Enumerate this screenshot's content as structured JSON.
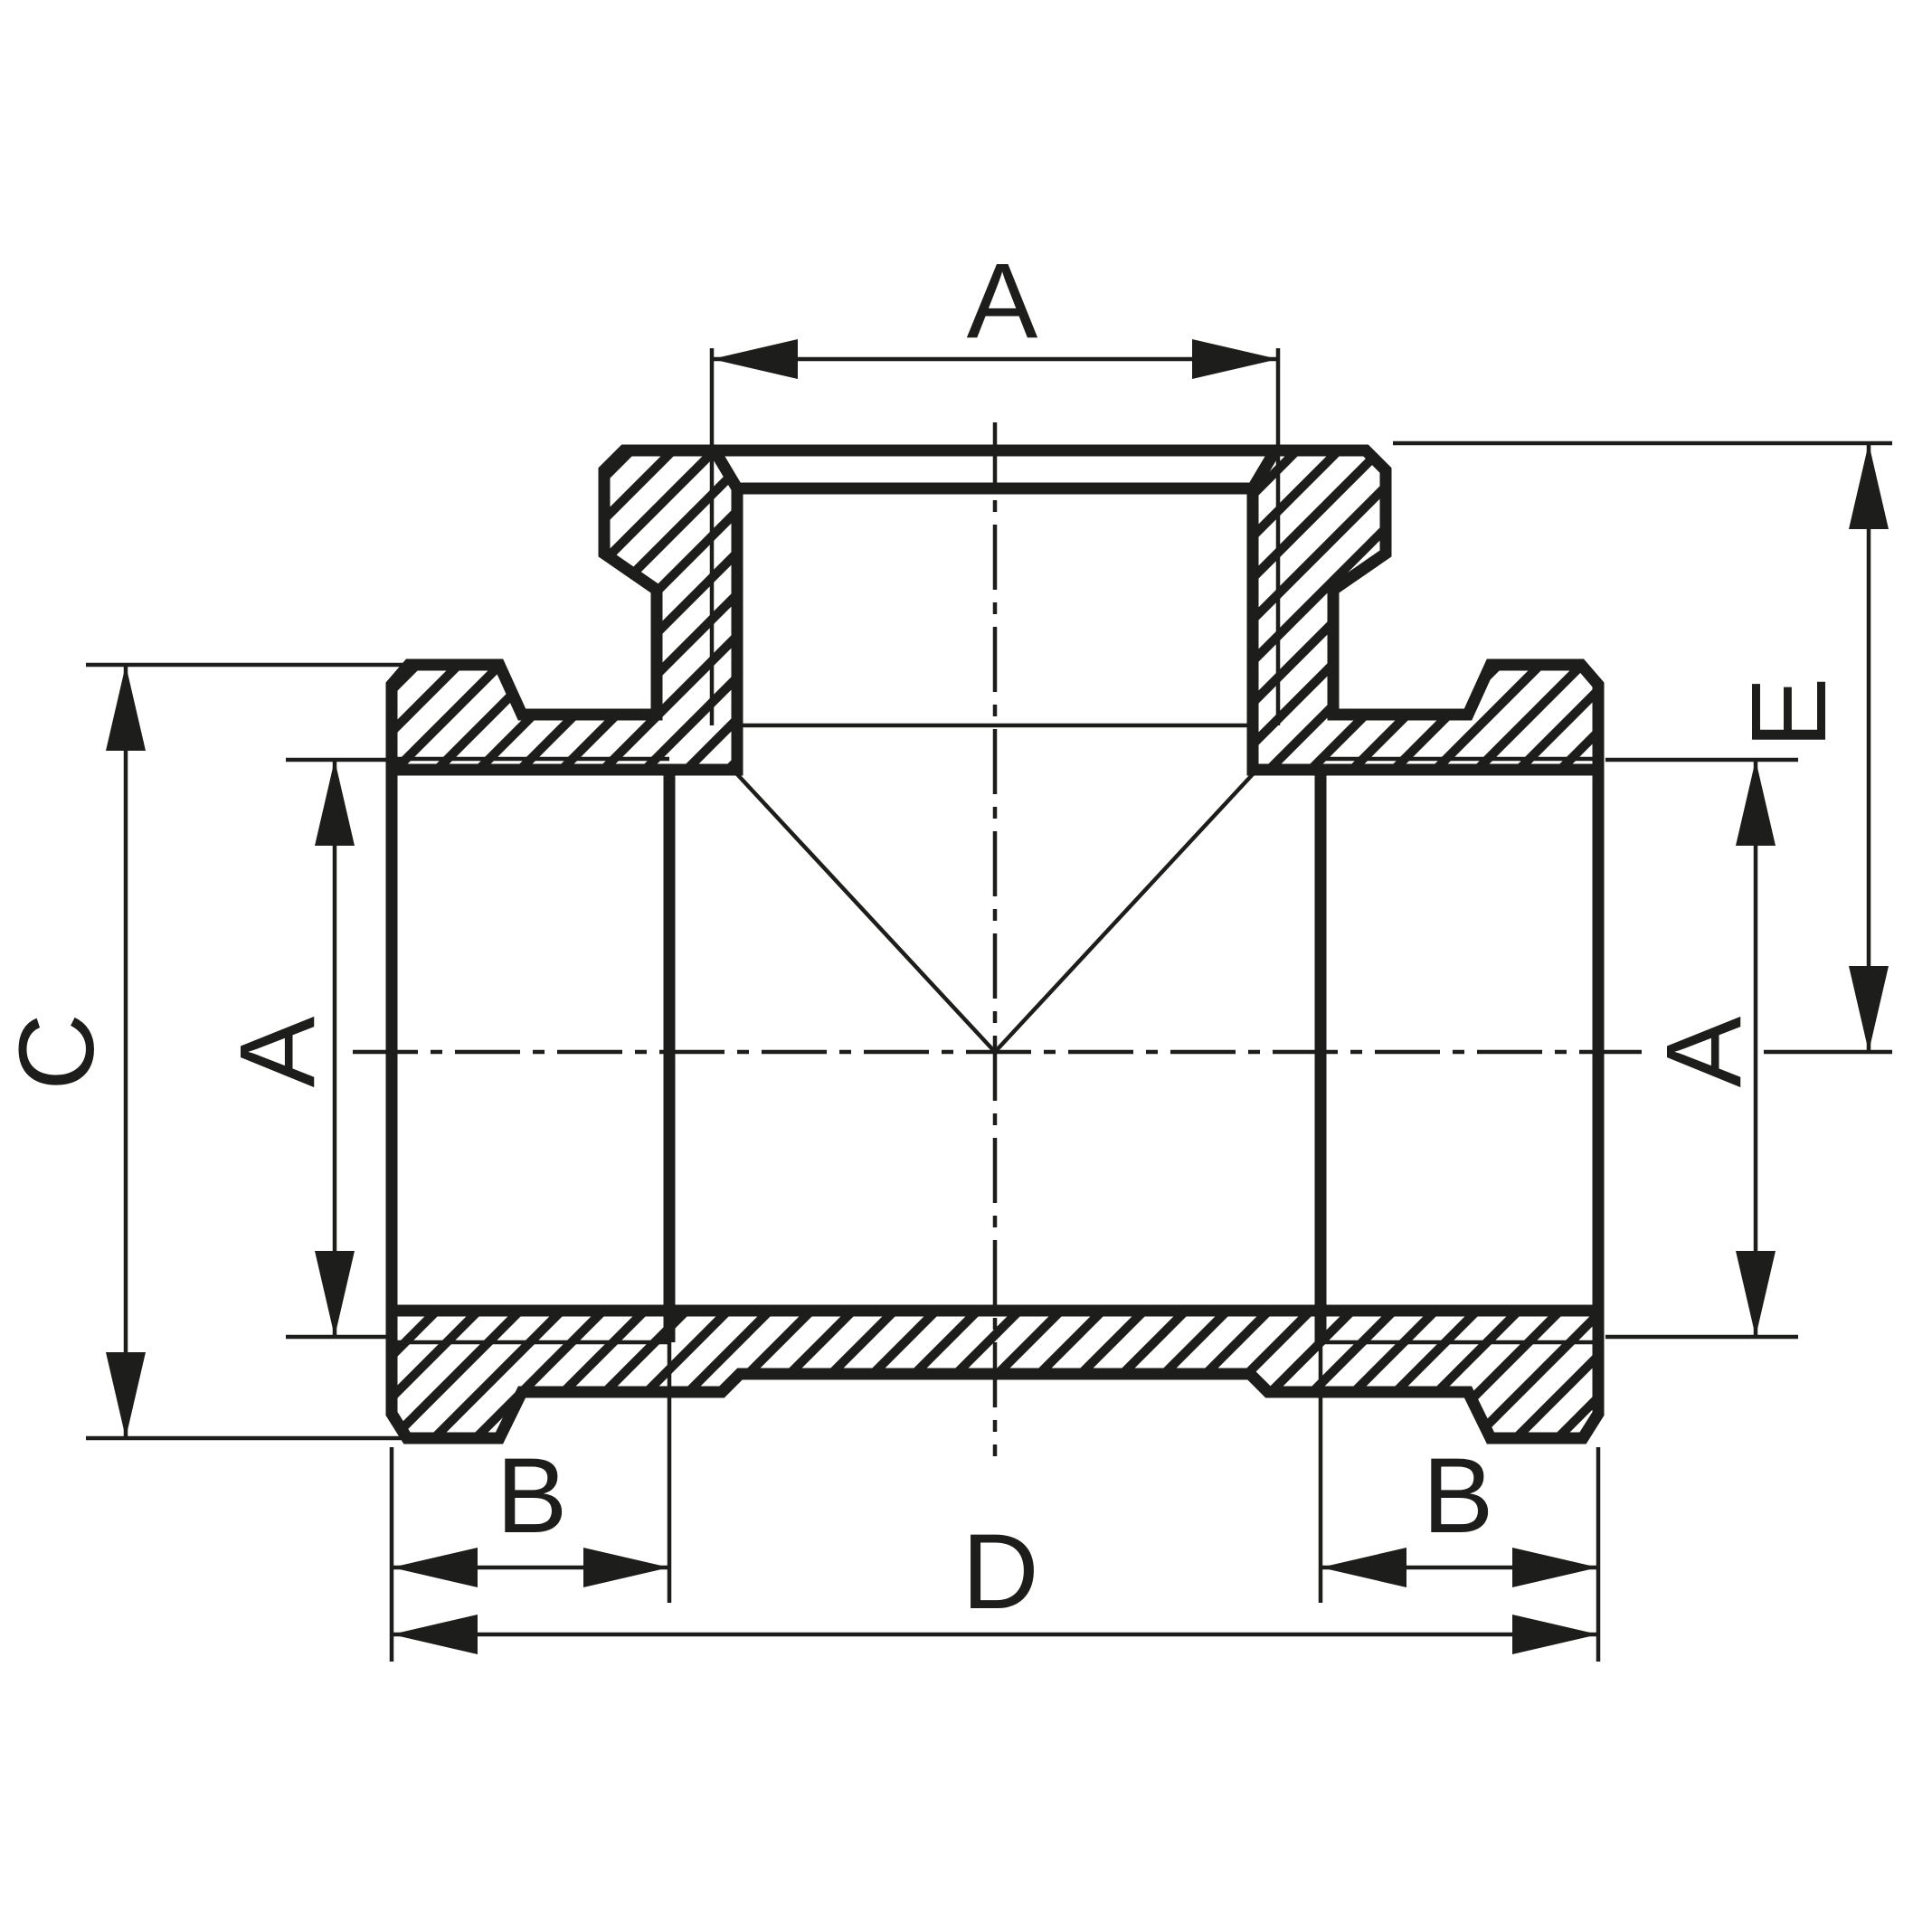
{
  "drawing": {
    "kind": "technical-drawing",
    "subject": "pipe-tee-fitting-cross-section",
    "view": "sectional view with hatched walls, centerlines and dimension callouts"
  },
  "style": {
    "ink": "#1d1d1b",
    "background": "#ffffff"
  },
  "labels": {
    "dim_a_top": "A",
    "dim_c": "C",
    "dim_a_left": "A",
    "dim_b_left": "B",
    "dim_d": "D",
    "dim_b_right": "B",
    "dim_a_right": "A",
    "dim_e": "E"
  }
}
